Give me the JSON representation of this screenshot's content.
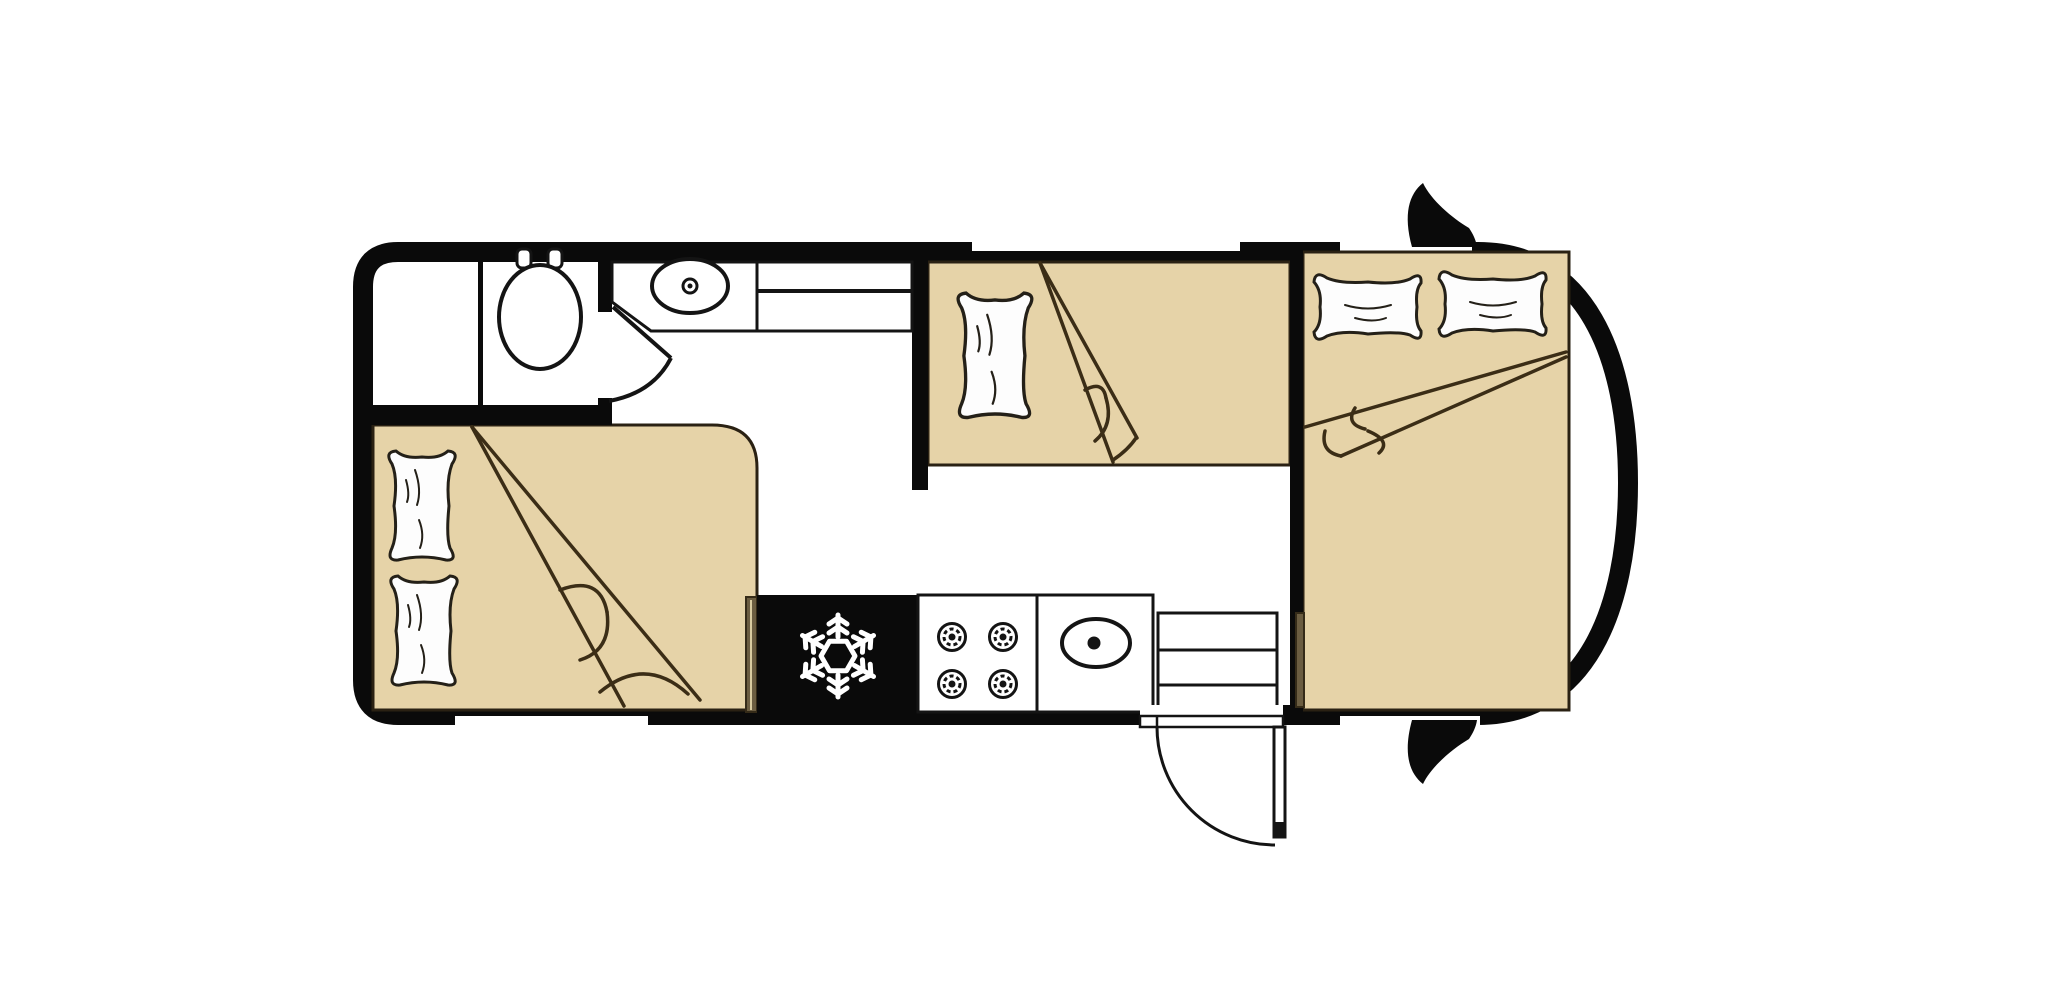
{
  "document": {
    "title": "Caravan floor plan",
    "type": "floor-plan",
    "visible_text": []
  },
  "colors": {
    "background": "#ffffff",
    "wall": "#0a0a0a",
    "bed": "#e6d3a8",
    "bed_outline": "#2a2113",
    "blanket_line": "#3b2d16",
    "pillow": "#fdfdfd",
    "pillow_outline": "#242018",
    "appliance_black": "#0a0a0a",
    "accent_bar": "#6b5d41",
    "accent_bar_edge": "#352b18",
    "accent_bar_highlight": "#d9cba0",
    "snowflake": "#ffffff",
    "fixture_line": "#141414"
  },
  "fixtures": {
    "icons": [
      "snowflake-icon",
      "wheel-icon",
      "toilet-icon",
      "sink-icon",
      "burner-icon",
      "door-swing-icon",
      "pillow-icon"
    ],
    "bed_count": 3,
    "pillow_count": 5,
    "hob_burner_count": 4,
    "window_count": 4,
    "wheel_count": 2,
    "step_count": 3
  }
}
